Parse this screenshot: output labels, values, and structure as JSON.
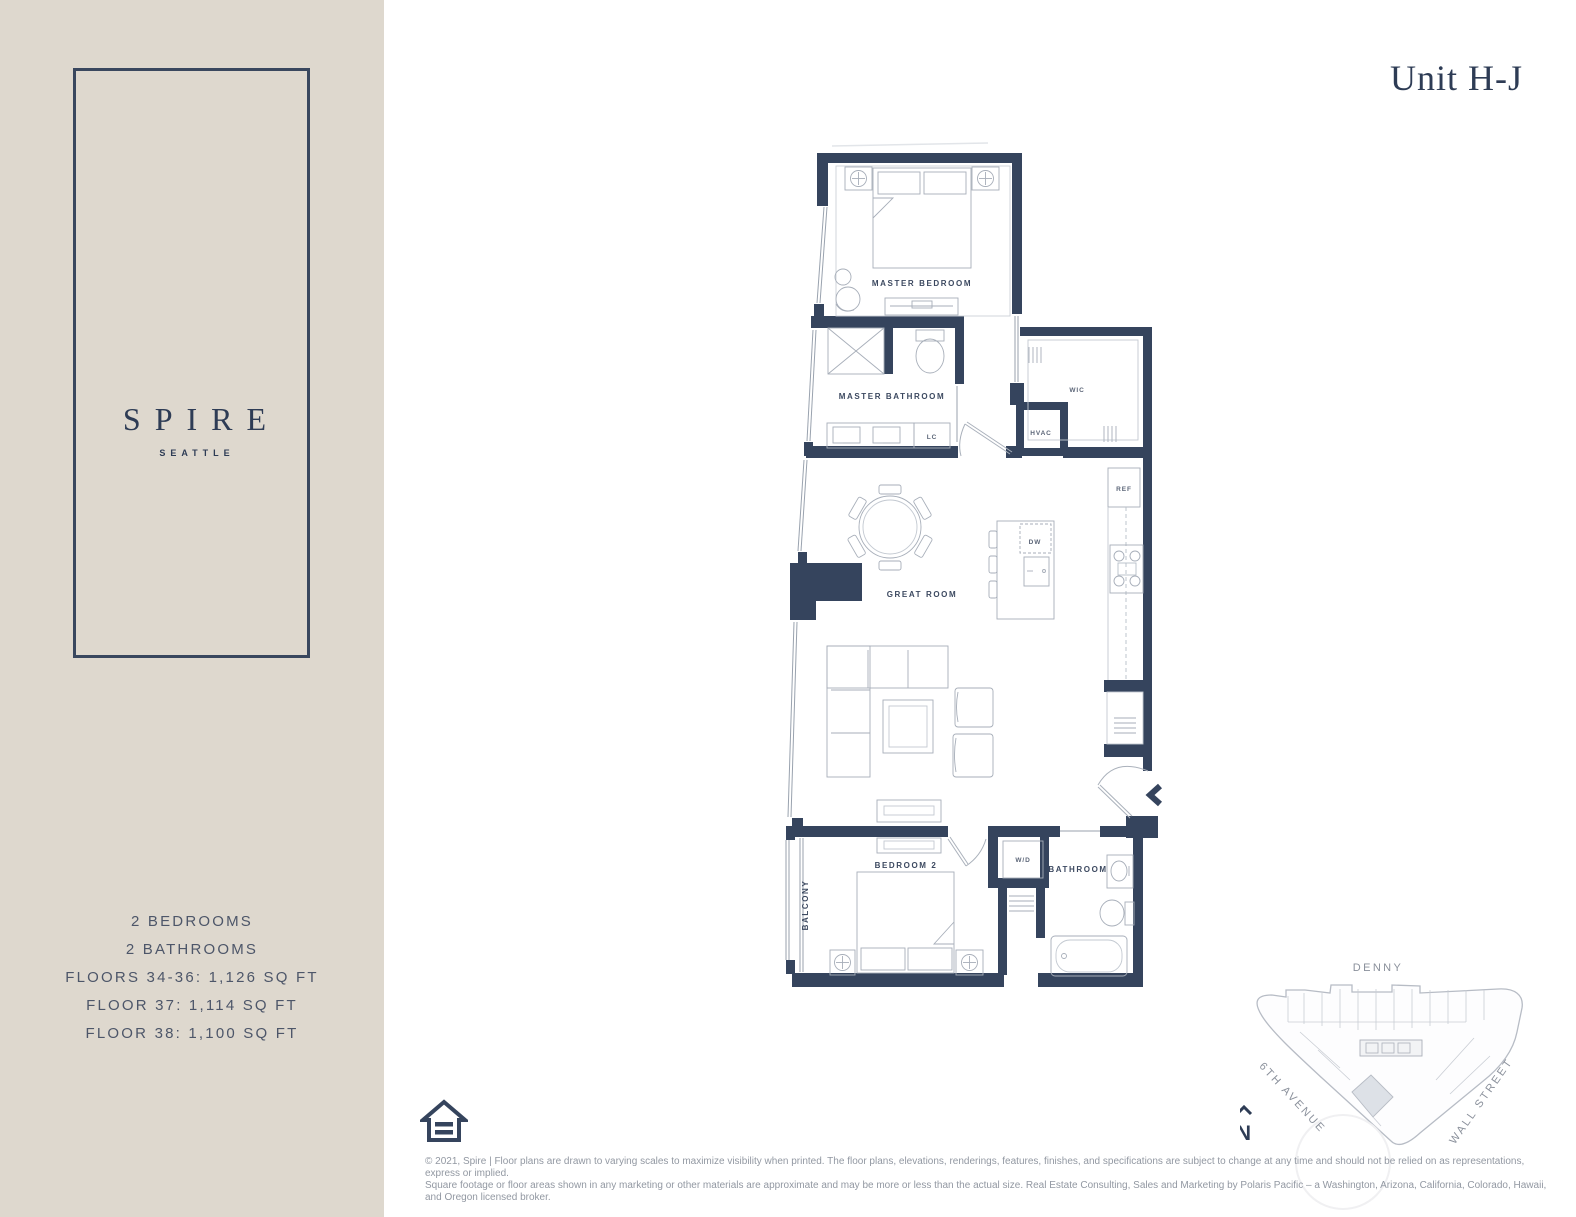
{
  "colors": {
    "sidebar_bg": "#ded8ce",
    "wall_navy": "#35445d",
    "brand_navy": "#2e3c55",
    "facts_text": "#4d5669",
    "muted_gray": "#8a909b",
    "highlight_unit_fill": "#dde1e7"
  },
  "sidebar": {
    "brand": "SPIRE",
    "brand_sub": "SEATTLE",
    "facts": [
      "2 BEDROOMS",
      "2 BATHROOMS",
      "FLOORS 34-36: 1,126 SQ FT",
      "FLOOR 37: 1,114 SQ FT",
      "FLOOR 38: 1,100 SQ FT"
    ]
  },
  "header": {
    "unit_title": "Unit H-J"
  },
  "floorplan": {
    "labels": {
      "master_bedroom": "MASTER BEDROOM",
      "master_bathroom": "MASTER BATHROOM",
      "wic": "WIC",
      "hvac": "HVAC",
      "lc": "LC",
      "great_room": "GREAT ROOM",
      "dw": "DW",
      "ref": "REF",
      "bedroom2": "BEDROOM 2",
      "wd": "W/D",
      "bathroom": "BATHROOM",
      "balcony": "BALCONY"
    }
  },
  "sitemap": {
    "street_top": "DENNY",
    "street_left": "6TH AVENUE",
    "street_right": "WALL STREET",
    "compass": "N"
  },
  "footer": {
    "lines": [
      "© 2021, Spire | Floor plans are drawn to varying scales to maximize visibility when printed. The floor plans, elevations, renderings, features, finishes, and specifications are subject to change at any time and should not be relied on as representations, express or implied.",
      "Square footage or floor areas shown in any marketing or other materials are approximate and may be more or less than the actual size. Real Estate Consulting, Sales and Marketing by Polaris Pacific – a Washington, Arizona, California, Colorado, Hawaii,",
      "and Oregon licensed broker."
    ]
  }
}
